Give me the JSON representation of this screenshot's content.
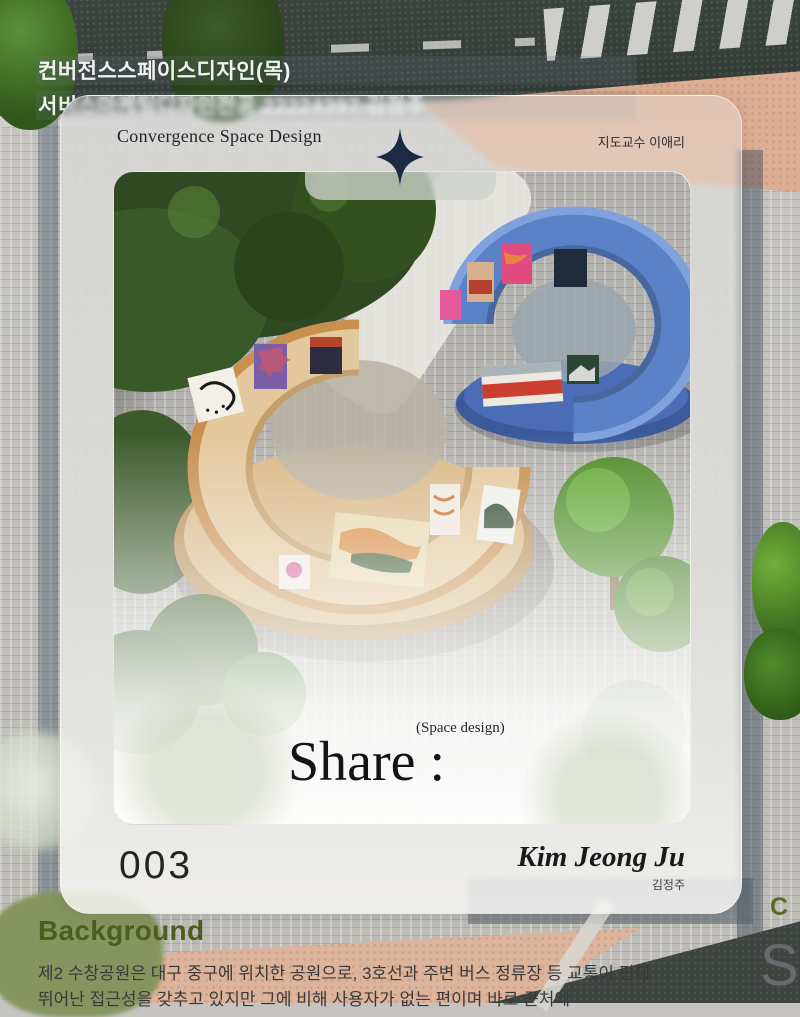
{
  "page_header": {
    "line1": "컨버전스스페이스디자인(목)",
    "line2": "서비스마케팅디자인전공 22224397 김정주"
  },
  "card": {
    "title": "Convergence Space Design",
    "advisor": "지도교수 이애리",
    "share_label": "Share :",
    "share_sublabel": "(Space design)",
    "page_number": "003",
    "author_en": "Kim Jeong Ju",
    "author_ko": "김정주"
  },
  "section": {
    "heading": "Background",
    "body_line1": "제2 수창공원은 대구 중구에 위치한 공원으로, 3호선과 주변 버스 정류장 등 교통이 편해",
    "body_line2": "뛰어난 접근성을 갖추고 있지만 그에 비해 사용자가 없는 편이며 바로 근처에"
  },
  "edge_fragments": {
    "c": "C",
    "s": "S"
  },
  "icons": {
    "sparkle": "four-point-star"
  },
  "colors": {
    "accent_olive": "#4d5e1c",
    "star_navy": "#1c2b45",
    "blue_ring": "#5b82c6",
    "beige_ring": "#e3c89d",
    "frost": "rgba(240,240,238,0.55)"
  },
  "photo": {
    "subject": "aerial view of park model with two C-shaped ring gallery pavilions (beige and blue)"
  }
}
